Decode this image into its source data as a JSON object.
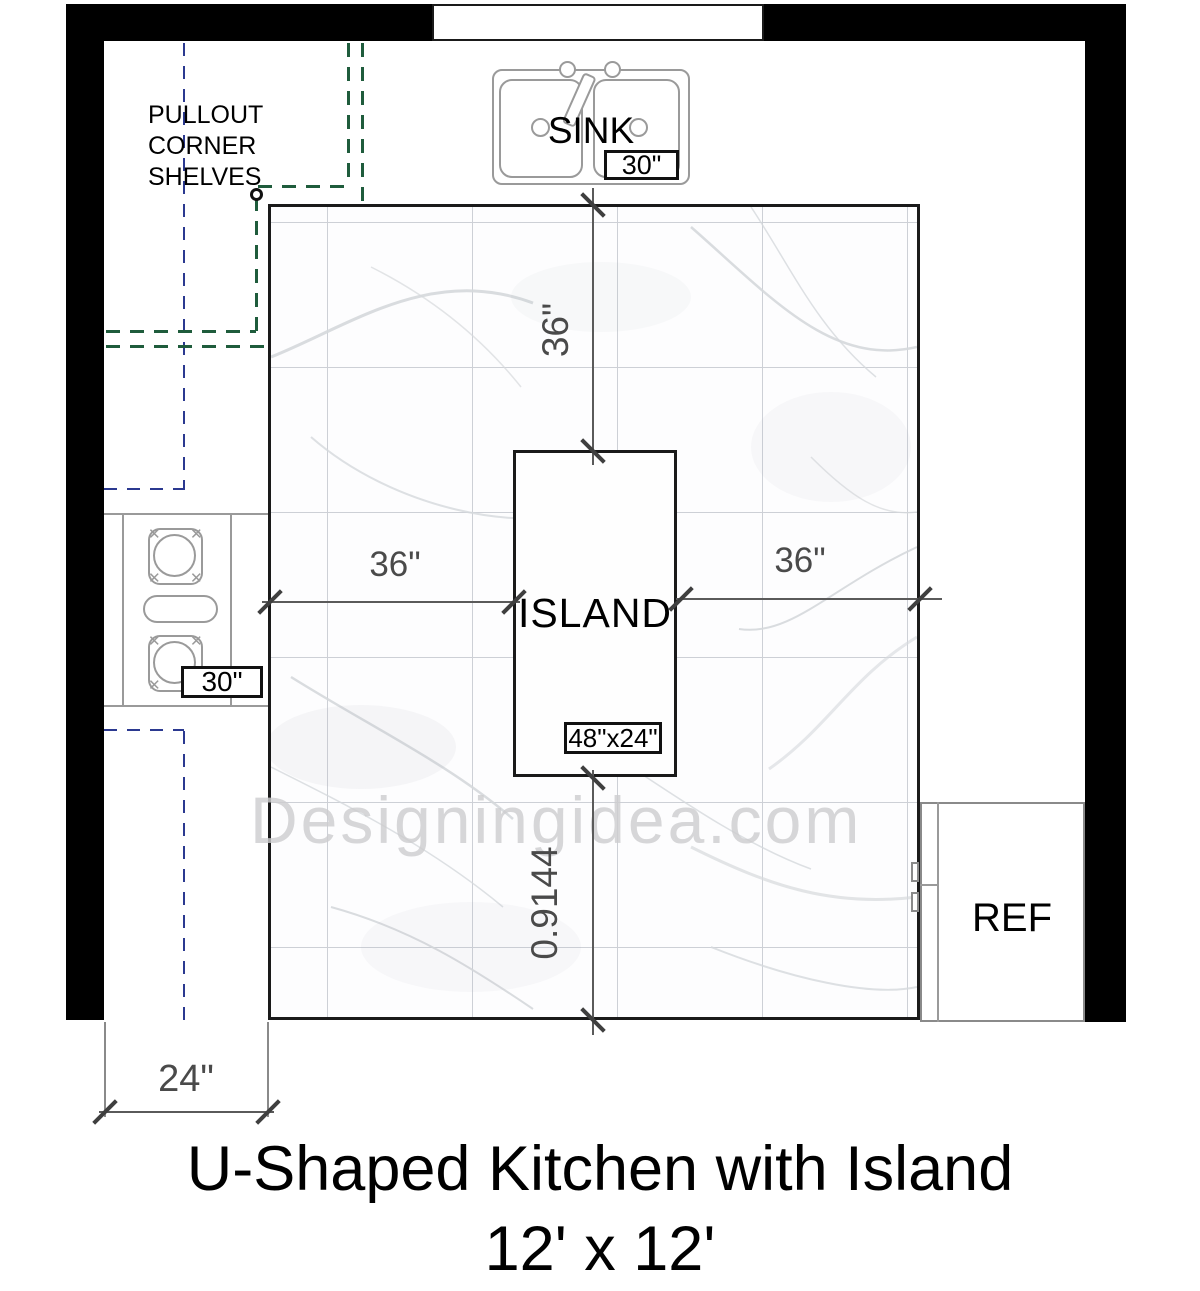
{
  "title": {
    "line1": "U-Shaped Kitchen with Island",
    "line2": "12' x 12'"
  },
  "watermark": "Designingidea.com",
  "labels": {
    "pullout_corner_shelves": [
      "PULLOUT",
      "CORNER",
      "SHELVES"
    ],
    "sink": "SINK",
    "island": "ISLAND",
    "ref": "REF"
  },
  "dimensions": {
    "sink_width": "30\"",
    "stove_width": "30\"",
    "island_size": "48\"x24\"",
    "sink_to_island": "36\"",
    "left_counter_to_island": "36\"",
    "island_to_right_counter": "36\"",
    "island_to_open_side": "0.9144",
    "counter_depth": "24\""
  },
  "colors": {
    "wall": "#000000",
    "floor_border": "#1a1a1a",
    "tile_grid": "#cdd0d6",
    "appliance_outline": "#9a9a9a",
    "upper_cabinet_dashed": "#2b3990",
    "pullout_shelf_dashed": "#1f5c3c",
    "dimension_line": "#5a5a5a",
    "dimension_text": "#4a4a4a",
    "watermark": "#cdcdcf"
  }
}
